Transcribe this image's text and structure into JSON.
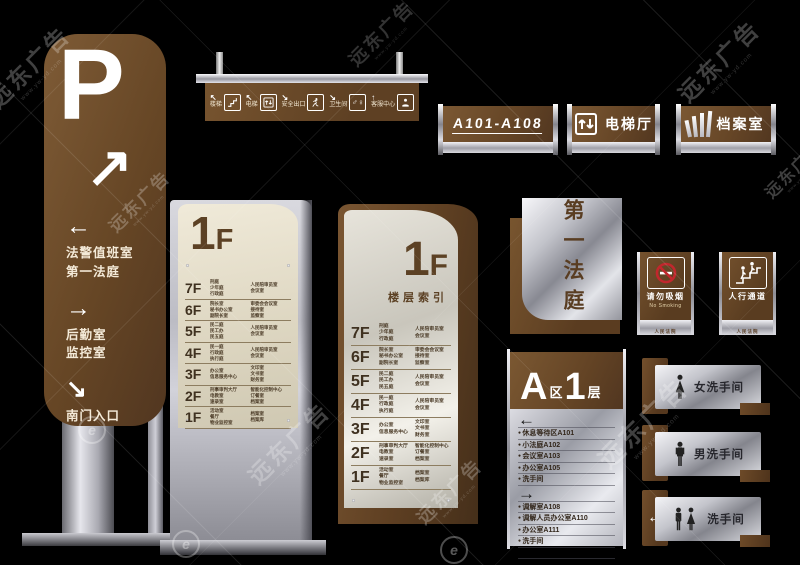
{
  "colors": {
    "background": "#000000",
    "brown": "#6b4a2b",
    "silver": "#c7c8cf",
    "beige": "#e7e2d2",
    "red": "#c1272d",
    "white": "#ffffff"
  },
  "watermark": {
    "text": "远东广告",
    "url": "www.yw-yd.com",
    "logo_glyph": "e"
  },
  "p_totem": {
    "letter": "P",
    "arrow": "↗",
    "destinations": [
      {
        "arrow": "←",
        "lines": "法警值班室\n第一法庭"
      },
      {
        "arrow": "→",
        "lines": "后勤室\n监控室"
      },
      {
        "arrow": "↘",
        "lines": "南门入口"
      }
    ]
  },
  "hanging_sign": {
    "items": [
      {
        "arrow": "↖",
        "label": "楼梯",
        "icon": "stairs-icon"
      },
      {
        "arrow": "↖",
        "label": "电梯",
        "icon": "elevator-icon"
      },
      {
        "arrow": "↘",
        "label": "安全出口",
        "icon": "exit-icon"
      },
      {
        "arrow": "↘",
        "label": "卫生间",
        "icon": "toilet-icon",
        "glyph": "♂♀"
      },
      {
        "arrow": "↑",
        "label": "客服中心",
        "icon": "service-icon"
      }
    ]
  },
  "door_plates": [
    {
      "label": "A101-A108"
    },
    {
      "label": "电梯厅",
      "icon": "elevator-icon"
    },
    {
      "label": "档案室",
      "icon": "archive-icon"
    }
  ],
  "floor_directory": {
    "title_number": "1",
    "title_suffix": "F",
    "subtitle": "楼层索引",
    "rows": [
      {
        "floor": "7F",
        "col1": "刑庭\n少年庭\n行政庭",
        "col2": "人民陪审员室\n会议室"
      },
      {
        "floor": "6F",
        "col1": "院长室\n秘书办公室\n副院长室",
        "col2": "审委会会议室\n接待室\n监察室"
      },
      {
        "floor": "5F",
        "col1": "民二庭\n民工办\n民五庭",
        "col2": "人民陪审员室\n会议室"
      },
      {
        "floor": "4F",
        "col1": "民一庭\n行政庭\n执行庭",
        "col2": "人民陪审员室\n会议室"
      },
      {
        "floor": "3F",
        "col1": "办公室\n信息服务中心",
        "col2": "文印室\n文书室\n财务室"
      },
      {
        "floor": "2F",
        "col1": "刑事审判大厅\n电教室\n速录室",
        "col2": "智能化控制中心\n订餐室\n档案室"
      },
      {
        "floor": "1F",
        "col1": "活动室\n餐厅\n物业监控室",
        "col2": "档案室\n档案库"
      }
    ]
  },
  "court_sign": {
    "text": "第一法庭"
  },
  "no_smoking_sign": {
    "title": "请勿吸烟",
    "subtitle": "No Smoking",
    "strip": "人民法院"
  },
  "walkway_sign": {
    "title": "人行通道",
    "strip": "人民法院"
  },
  "zone_directory": {
    "zone_letter": "A",
    "zone_suffix": "区",
    "floor_number": "1",
    "floor_suffix": "层",
    "left_arrow": "←",
    "right_arrow": "→",
    "left_items": [
      "休息等待区A101",
      "小法庭A102",
      "会议室A103",
      "办公室A105",
      "洗手间"
    ],
    "right_items": [
      "调解室A108",
      "调解人员办公室A110",
      "办公室A111",
      "洗手间"
    ]
  },
  "restroom_signs": [
    {
      "label": "女洗手间",
      "icon": "woman-icon"
    },
    {
      "label": "男洗手间",
      "icon": "man-icon"
    },
    {
      "label": "洗手间",
      "icon": "man-woman-icon",
      "arrow": "←"
    }
  ]
}
